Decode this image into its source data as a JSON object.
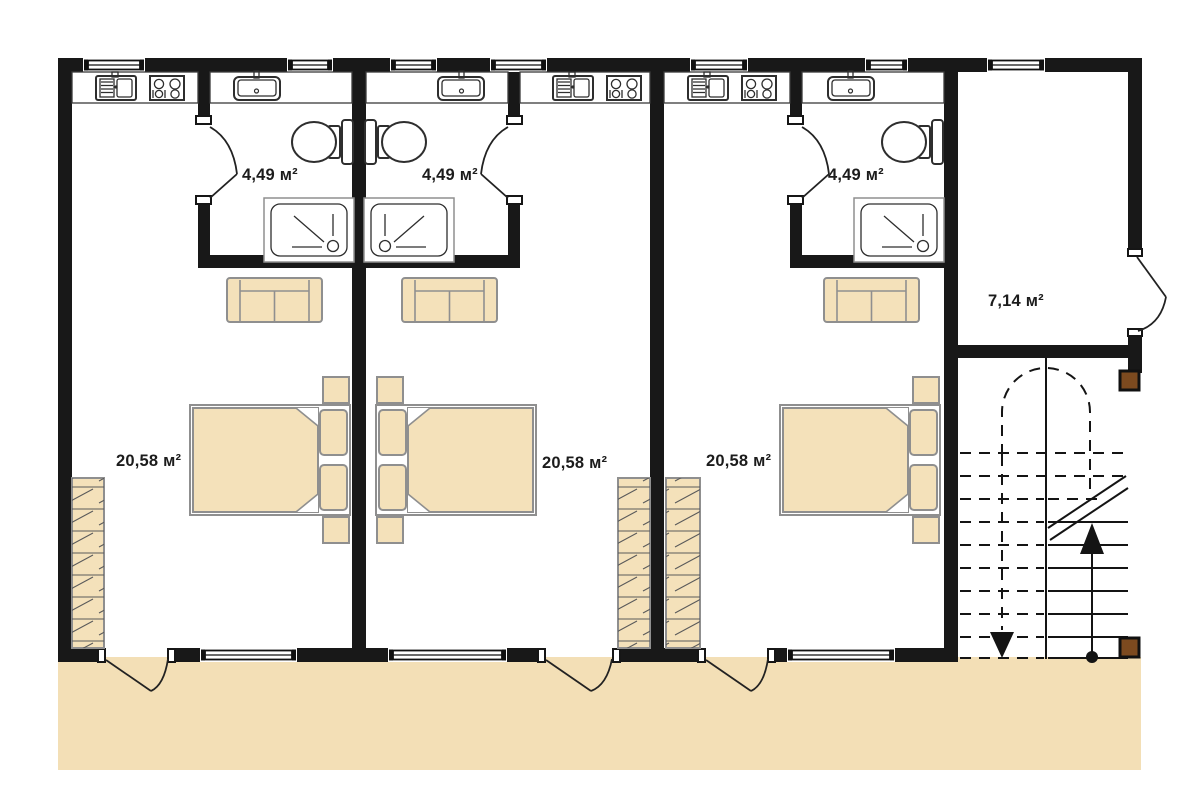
{
  "floor_plan": {
    "units": [
      {
        "name": "unit-1",
        "bathroom_area": "4,49 м²",
        "bedroom_area": "20,58 м²"
      },
      {
        "name": "unit-2",
        "bathroom_area": "4,49 м²",
        "bedroom_area": "20,58 м²"
      },
      {
        "name": "unit-3",
        "bathroom_area": "4,49 м²",
        "bedroom_area": "20,58 м²"
      }
    ],
    "hall_area": "7,14 м²"
  },
  "colors": {
    "background": "#ffffff",
    "wall": "#181818",
    "terrace": "#f3dfb6",
    "furniture_fill": "#f4e1ba",
    "furniture_outline": "#8f8f8f",
    "fixture_outline": "#2e2e2e",
    "stair_line": "#141414",
    "post": "#7c4a1f",
    "label_text": "#1c1c1c"
  },
  "icons": {
    "toilet-icon": "top-view toilet with tank",
    "shower-icon": "shower tray with drain",
    "washbasin-icon": "bathroom sink with tap",
    "kitchen-sink-icon": "kitchen sink with drainboard",
    "stove-icon": "four-burner cooktop",
    "bed-icon": "double bed with two pillows",
    "nightstand-icon": "bedside table",
    "sofa-icon": "two-seat sofa",
    "wardrobe-icon": "hatched wardrobe",
    "window-icon": "double-line window",
    "door-swing-icon": "door leaf with swing arc",
    "stairs-icon": "staircase, dashed flight above cut line",
    "stair-up-arrow-icon": "solid up arrow with start dot",
    "stair-down-arrow-icon": "dashed down arrow",
    "post-icon": "brown timber post"
  }
}
